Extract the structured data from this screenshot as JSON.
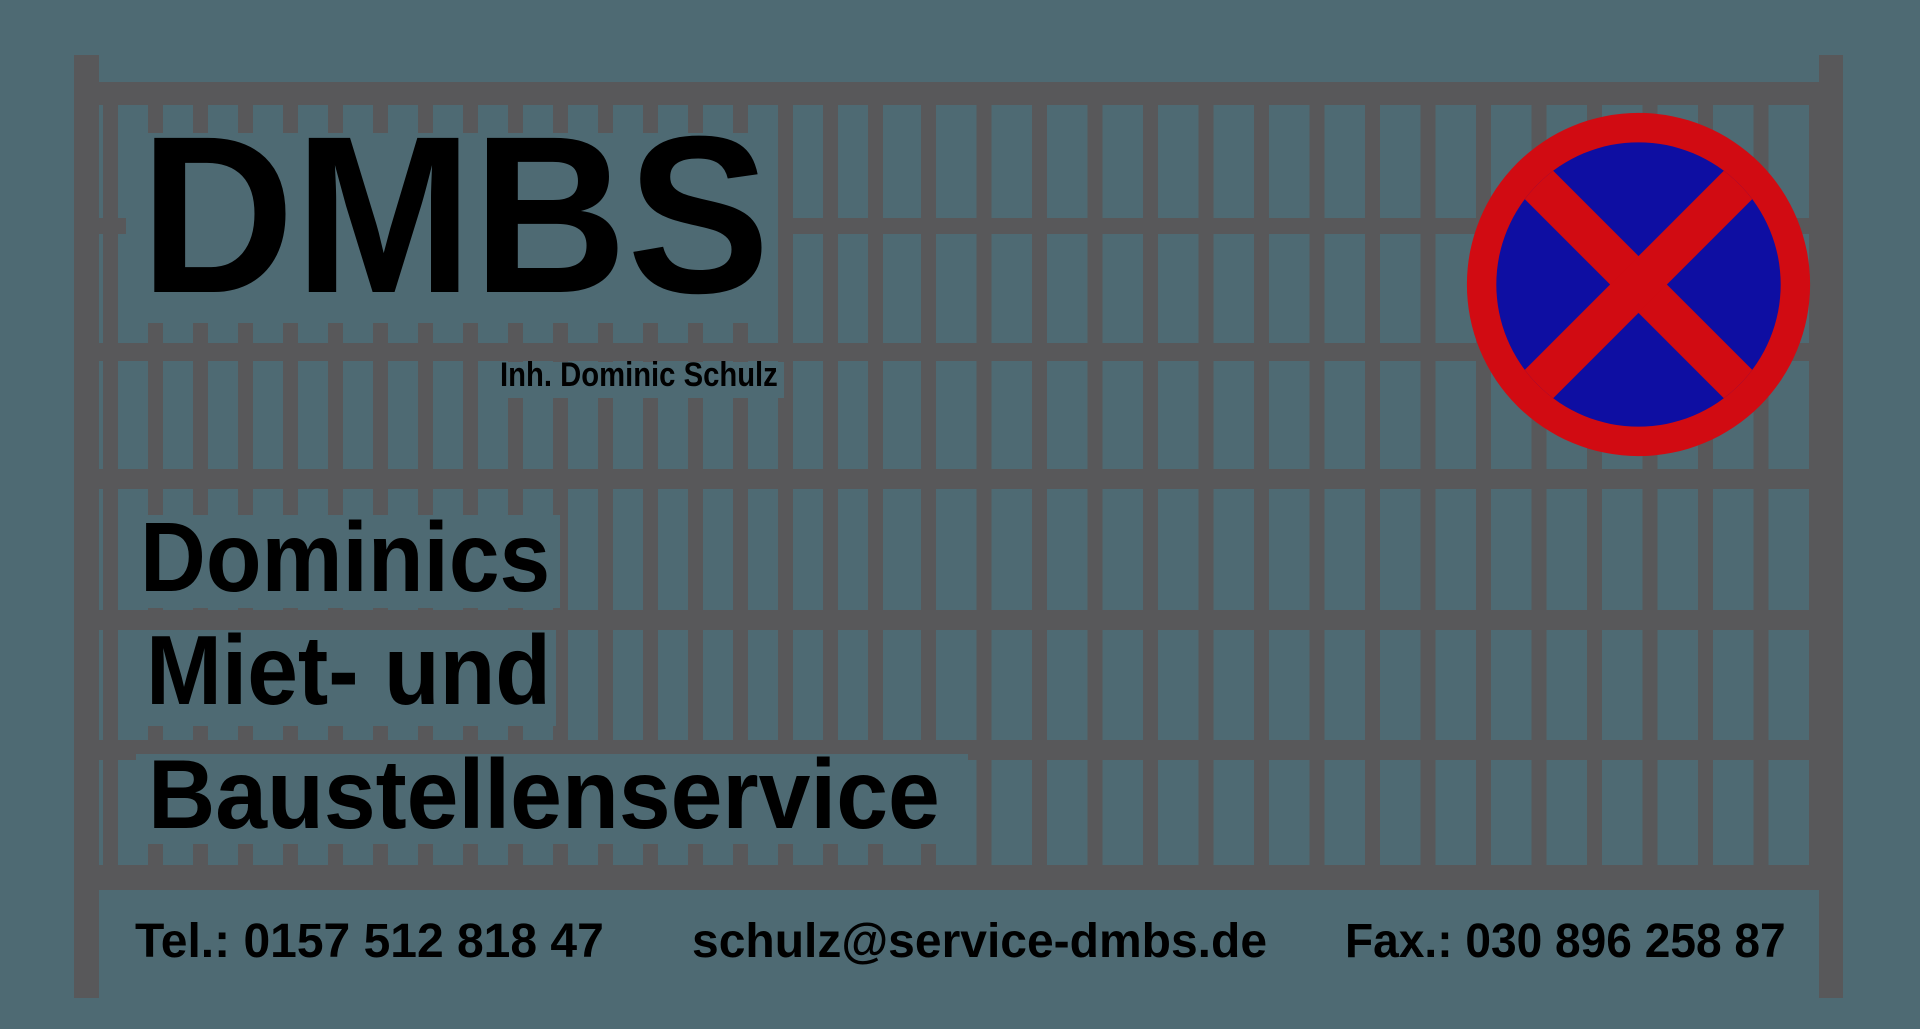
{
  "brand": {
    "name": "DMBS",
    "owner": "Inh. Dominic Schulz",
    "tagline_lines": [
      "Dominics",
      "Miet- und",
      "Baustellenservice"
    ]
  },
  "contact": {
    "phone": "Tel.: 0157 512 818 47",
    "email": "schulz@service-dmbs.de",
    "fax": "Fax.: 030 896 258 87"
  },
  "icons": {
    "no_stopping_sign": "no-stopping-sign"
  },
  "colors": {
    "background": "#4e6a73",
    "fence": "#58585a",
    "text": "#000000",
    "sign_red": "#d10b12",
    "sign_blue": "#0e0ea2"
  }
}
